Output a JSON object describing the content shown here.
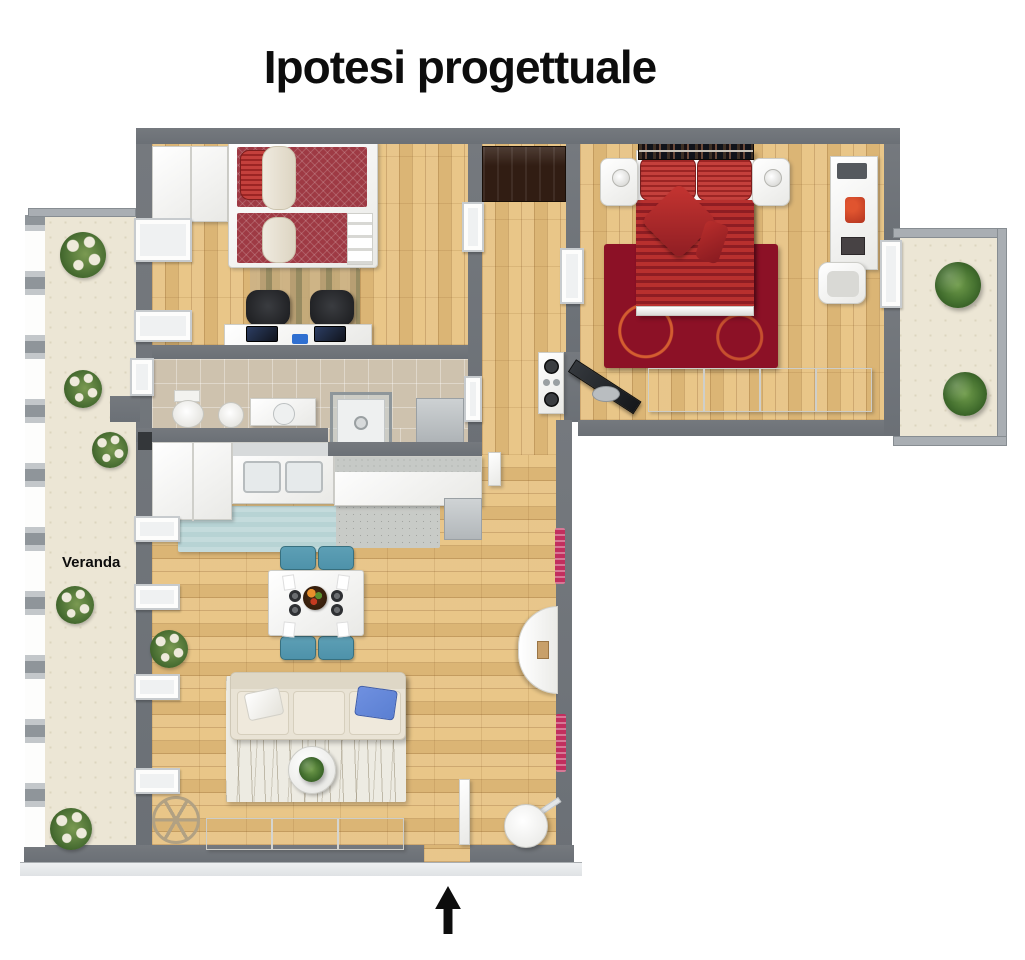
{
  "title": "Ipotesi progettuale",
  "labels": {
    "veranda": "Veranda"
  },
  "colors": {
    "wall": "#6b7076",
    "wallLight": "#a9aeb3",
    "ledge": "#dfe2e5",
    "wood": "#e6c07e",
    "tile": "#cec2ae",
    "cream": "#ece6d5",
    "bedRedDark": "#8e1d23",
    "rugRed": "#8c1126",
    "bunkRed": "#9e3a44",
    "chairTeal": "#4e92aa",
    "pillowBlue": "#5a7fd2",
    "sofa": "#e9e3d5",
    "rugLiving": "#edebe2",
    "rugKitchen": "#b7d3d4",
    "rugStripes": "#c2a878",
    "closet": "#311d13",
    "plant": "#44702f",
    "radiator": "#c22f5e",
    "chairBlack": "#202124",
    "ink": "#0d0d0d"
  }
}
